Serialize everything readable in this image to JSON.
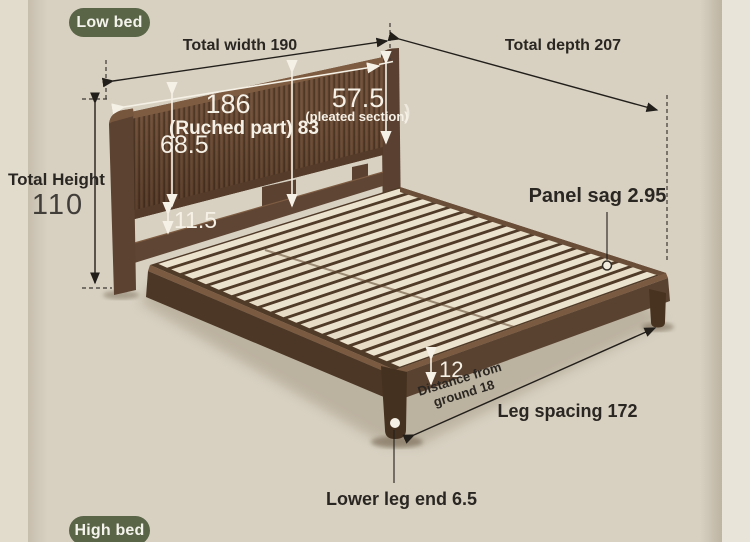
{
  "badges": {
    "low_bed": "Low bed",
    "high_bed": "High bed"
  },
  "labels": {
    "total_width": "Total width 190",
    "total_depth": "Total depth 207",
    "total_height_caption": "Total Height",
    "total_height_value": "110",
    "headboard_width": "186",
    "ruched_part": "(Ruched part) 83",
    "headboard_panel_height": "68.5",
    "pleated_width": "57.5",
    "pleated_caption": "(pleated section)",
    "pleated_extra_paren": ")",
    "rail_gap": "11.5",
    "panel_sag": "Panel sag 2.95",
    "frame_height": "12",
    "ground_clearance_line1": "Distance from",
    "ground_clearance_line2": "ground 18",
    "leg_spacing": "Leg spacing 172",
    "lower_leg_end": "Lower leg end 6.5"
  },
  "colors": {
    "background": "#d8d1c2",
    "wall_light": "#e9e4d9",
    "badge": "#5a6548",
    "ink": "#2a2622",
    "white_ink": "#f6f1e6",
    "wood_dark": "#4c3625",
    "wood_mid": "#6d4e38",
    "wood_light": "#7d5c42",
    "slat": "#ece3ce"
  }
}
